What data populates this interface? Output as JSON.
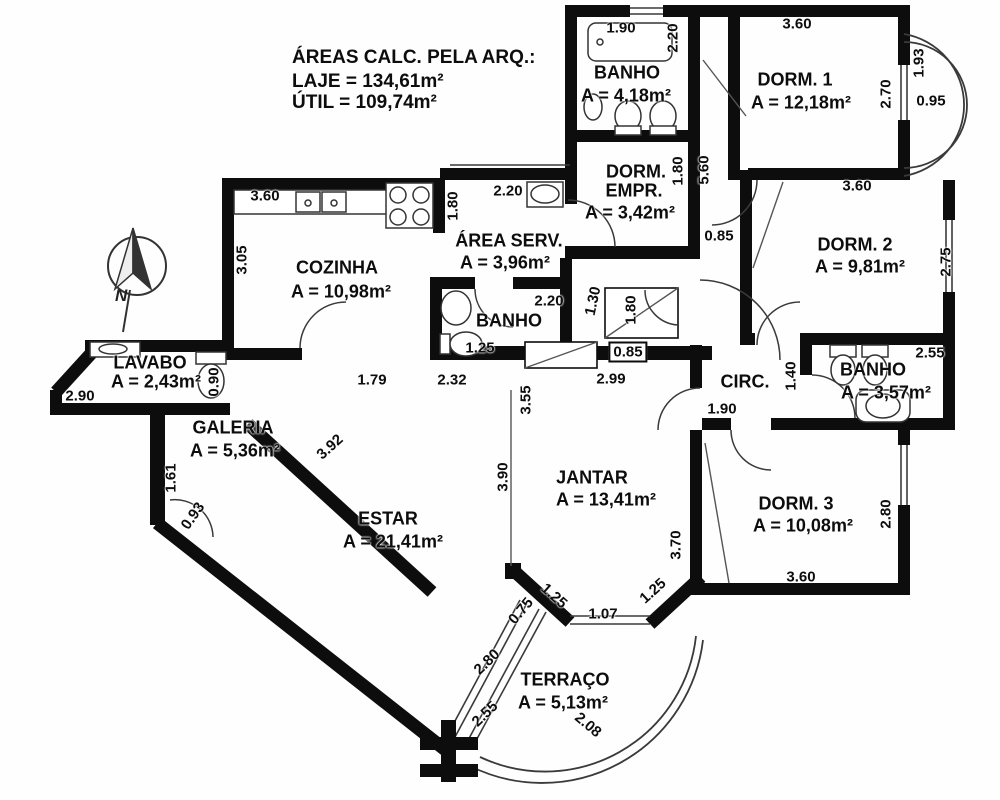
{
  "header": {
    "title": "ÁREAS CALC. PELA ARQ.:",
    "laje": "LAJE = 134,61m²",
    "util": "ÚTIL = 109,74m²"
  },
  "compass": {
    "north_label": "N"
  },
  "colors": {
    "wall": "#0d0d0d",
    "background": "#fefefe",
    "thin_line": "#3a3a3a"
  },
  "rooms": [
    {
      "id": "banho-superior",
      "lines": [
        {
          "text": "BANHO",
          "x": 627,
          "y": 73
        },
        {
          "text": "A = 4,18m²",
          "x": 626,
          "y": 96
        }
      ]
    },
    {
      "id": "dorm-1",
      "lines": [
        {
          "text": "DORM. 1",
          "x": 795,
          "y": 80
        },
        {
          "text": "A = 12,18m²",
          "x": 801,
          "y": 103
        }
      ]
    },
    {
      "id": "dorm-empr",
      "lines": [
        {
          "text": "DORM.",
          "x": 636,
          "y": 172
        },
        {
          "text": "EMPR.",
          "x": 634,
          "y": 191
        },
        {
          "text": "A = 3,42m²",
          "x": 630,
          "y": 213
        }
      ]
    },
    {
      "id": "area-serv",
      "lines": [
        {
          "text": "ÁREA SERV.",
          "x": 509,
          "y": 241
        },
        {
          "text": "A = 3,96m²",
          "x": 505,
          "y": 263
        }
      ]
    },
    {
      "id": "cozinha",
      "lines": [
        {
          "text": "COZINHA",
          "x": 337,
          "y": 268
        },
        {
          "text": "A = 10,98m²",
          "x": 341,
          "y": 292
        }
      ]
    },
    {
      "id": "dorm-2",
      "lines": [
        {
          "text": "DORM. 2",
          "x": 855,
          "y": 245
        },
        {
          "text": "A = 9,81m²",
          "x": 860,
          "y": 267
        }
      ]
    },
    {
      "id": "banho-meio",
      "lines": [
        {
          "text": "BANHO",
          "x": 509,
          "y": 321
        }
      ]
    },
    {
      "id": "lavabo",
      "lines": [
        {
          "text": "LAVABO",
          "x": 150,
          "y": 363
        },
        {
          "text": "A = 2,43m²",
          "x": 156,
          "y": 382
        }
      ]
    },
    {
      "id": "circ",
      "lines": [
        {
          "text": "CIRC.",
          "x": 745,
          "y": 382
        }
      ]
    },
    {
      "id": "banho-suite",
      "lines": [
        {
          "text": "BANHO",
          "x": 873,
          "y": 370
        },
        {
          "text": "A = 3,57m²",
          "x": 886,
          "y": 393
        }
      ]
    },
    {
      "id": "galeria",
      "lines": [
        {
          "text": "GALERIA",
          "x": 233,
          "y": 428
        },
        {
          "text": "A = 5,36m²",
          "x": 235,
          "y": 451
        }
      ]
    },
    {
      "id": "jantar",
      "lines": [
        {
          "text": "JANTAR",
          "x": 592,
          "y": 478
        },
        {
          "text": "A = 13,41m²",
          "x": 606,
          "y": 500
        }
      ]
    },
    {
      "id": "estar",
      "lines": [
        {
          "text": "ESTAR",
          "x": 388,
          "y": 519
        },
        {
          "text": "A = 21,41m²",
          "x": 393,
          "y": 542
        }
      ]
    },
    {
      "id": "dorm-3",
      "lines": [
        {
          "text": "DORM. 3",
          "x": 796,
          "y": 504
        },
        {
          "text": "A = 10,08m²",
          "x": 803,
          "y": 526
        }
      ]
    },
    {
      "id": "terraco",
      "lines": [
        {
          "text": "TERRAÇO",
          "x": 565,
          "y": 680
        },
        {
          "text": "A = 5,13m²",
          "x": 563,
          "y": 703
        }
      ]
    }
  ],
  "dimensions": [
    {
      "text": "1.90",
      "x": 621,
      "y": 28,
      "rot": 0
    },
    {
      "text": "2.20",
      "x": 673,
      "y": 38,
      "rot": -90
    },
    {
      "text": "3.60",
      "x": 797,
      "y": 24,
      "rot": 0
    },
    {
      "text": "2.70",
      "x": 886,
      "y": 94,
      "rot": -90
    },
    {
      "text": "1.93",
      "x": 919,
      "y": 63,
      "rot": -90
    },
    {
      "text": "0.95",
      "x": 931,
      "y": 101,
      "rot": 0
    },
    {
      "text": "3.60",
      "x": 265,
      "y": 196,
      "rot": 0
    },
    {
      "text": "1.80",
      "x": 453,
      "y": 206,
      "rot": -90
    },
    {
      "text": "2.20",
      "x": 508,
      "y": 191,
      "rot": 0
    },
    {
      "text": "1.80",
      "x": 678,
      "y": 171,
      "rot": -90
    },
    {
      "text": "5.60",
      "x": 704,
      "y": 170,
      "rot": -90
    },
    {
      "text": "0.85",
      "x": 719,
      "y": 236,
      "rot": 0
    },
    {
      "text": "3.60",
      "x": 857,
      "y": 186,
      "rot": 0
    },
    {
      "text": "2.75",
      "x": 946,
      "y": 262,
      "rot": -90
    },
    {
      "text": "3.05",
      "x": 242,
      "y": 260,
      "rot": -90
    },
    {
      "text": "2.20",
      "x": 549,
      "y": 301,
      "rot": 0
    },
    {
      "text": "1.30",
      "x": 593,
      "y": 301,
      "rot": -78
    },
    {
      "text": "1.80",
      "x": 631,
      "y": 310,
      "rot": -90
    },
    {
      "text": "1.25",
      "x": 480,
      "y": 348,
      "rot": 0
    },
    {
      "text": "0.85",
      "x": 628,
      "y": 352,
      "rot": 0,
      "boxed": true
    },
    {
      "text": "2.55",
      "x": 930,
      "y": 353,
      "rot": 0
    },
    {
      "text": "0.90",
      "x": 214,
      "y": 382,
      "rot": -90
    },
    {
      "text": "2.90",
      "x": 80,
      "y": 396,
      "rot": 0
    },
    {
      "text": "1.79",
      "x": 372,
      "y": 380,
      "rot": 0
    },
    {
      "text": "2.32",
      "x": 452,
      "y": 380,
      "rot": 0
    },
    {
      "text": "2.99",
      "x": 611,
      "y": 379,
      "rot": 0
    },
    {
      "text": "3.55",
      "x": 526,
      "y": 400,
      "rot": -90
    },
    {
      "text": "1.90",
      "x": 722,
      "y": 409,
      "rot": 0
    },
    {
      "text": "1.40",
      "x": 791,
      "y": 376,
      "rot": -90
    },
    {
      "text": "1.61",
      "x": 171,
      "y": 478,
      "rot": -90
    },
    {
      "text": "3.92",
      "x": 330,
      "y": 447,
      "rot": -42
    },
    {
      "text": "0.93",
      "x": 193,
      "y": 516,
      "rot": -55
    },
    {
      "text": "3.90",
      "x": 503,
      "y": 477,
      "rot": -90
    },
    {
      "text": "3.70",
      "x": 676,
      "y": 545,
      "rot": -90
    },
    {
      "text": "2.80",
      "x": 886,
      "y": 514,
      "rot": -90
    },
    {
      "text": "3.60",
      "x": 801,
      "y": 577,
      "rot": 0
    },
    {
      "text": "1.25",
      "x": 554,
      "y": 596,
      "rot": 42
    },
    {
      "text": "1.25",
      "x": 653,
      "y": 591,
      "rot": -42
    },
    {
      "text": "1.07",
      "x": 603,
      "y": 614,
      "rot": 0
    },
    {
      "text": "0.75",
      "x": 521,
      "y": 611,
      "rot": -50
    },
    {
      "text": "2.80",
      "x": 487,
      "y": 662,
      "rot": -44
    },
    {
      "text": "2.55",
      "x": 485,
      "y": 714,
      "rot": -44
    },
    {
      "text": "2.08",
      "x": 588,
      "y": 725,
      "rot": 40
    }
  ]
}
